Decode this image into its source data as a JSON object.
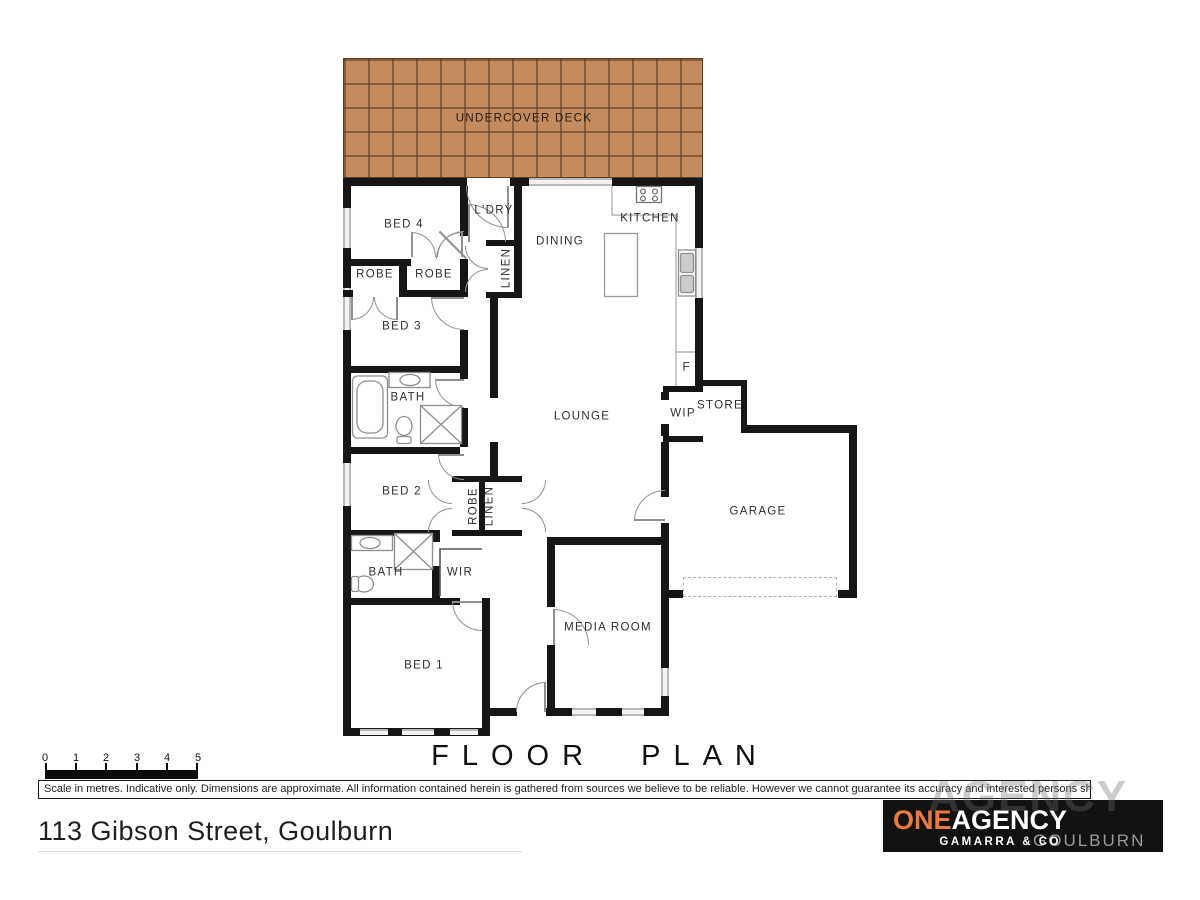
{
  "labels": {
    "deck": "UNDERCOVER DECK",
    "bed4": "BED 4",
    "ldry": "L'DRY",
    "dining": "DINING",
    "kitchen": "KITCHEN",
    "robe_top_left": "ROBE",
    "robe_top_right": "ROBE",
    "linen_top": "LINEN",
    "bed3": "BED 3",
    "bath_top": "BATH",
    "lounge": "LOUNGE",
    "wip": "WIP",
    "store": "STORE",
    "fridge": "F",
    "garage": "GARAGE",
    "bed2": "BED 2",
    "robe_mid": "ROBE",
    "linen_mid": "LINEN",
    "bath_lower": "BATH",
    "wir": "WIR",
    "bed1": "BED 1",
    "media": "MEDIA ROOM"
  },
  "title": "FLOOR PLAN",
  "scale": {
    "ticks": [
      "0",
      "1",
      "2",
      "3",
      "4",
      "5"
    ]
  },
  "disclaimer": "Scale in metres. Indicative only. Dimensions are approximate. All information contained herein is gathered from sources we believe to be reliable. However we cannot guarantee its accuracy and interested persons should rely on their own enquiries.",
  "address": "113 Gibson Street, Goulburn",
  "logo": {
    "one": "ONE",
    "agency": "AGENCY",
    "sub": "GAMARRA & CO",
    "region": "GOULBURN",
    "watermark": "AGENCY"
  },
  "colors": {
    "deck_tile": "#c48b5e",
    "wall": "#161616",
    "logo_orange": "#e87941"
  }
}
